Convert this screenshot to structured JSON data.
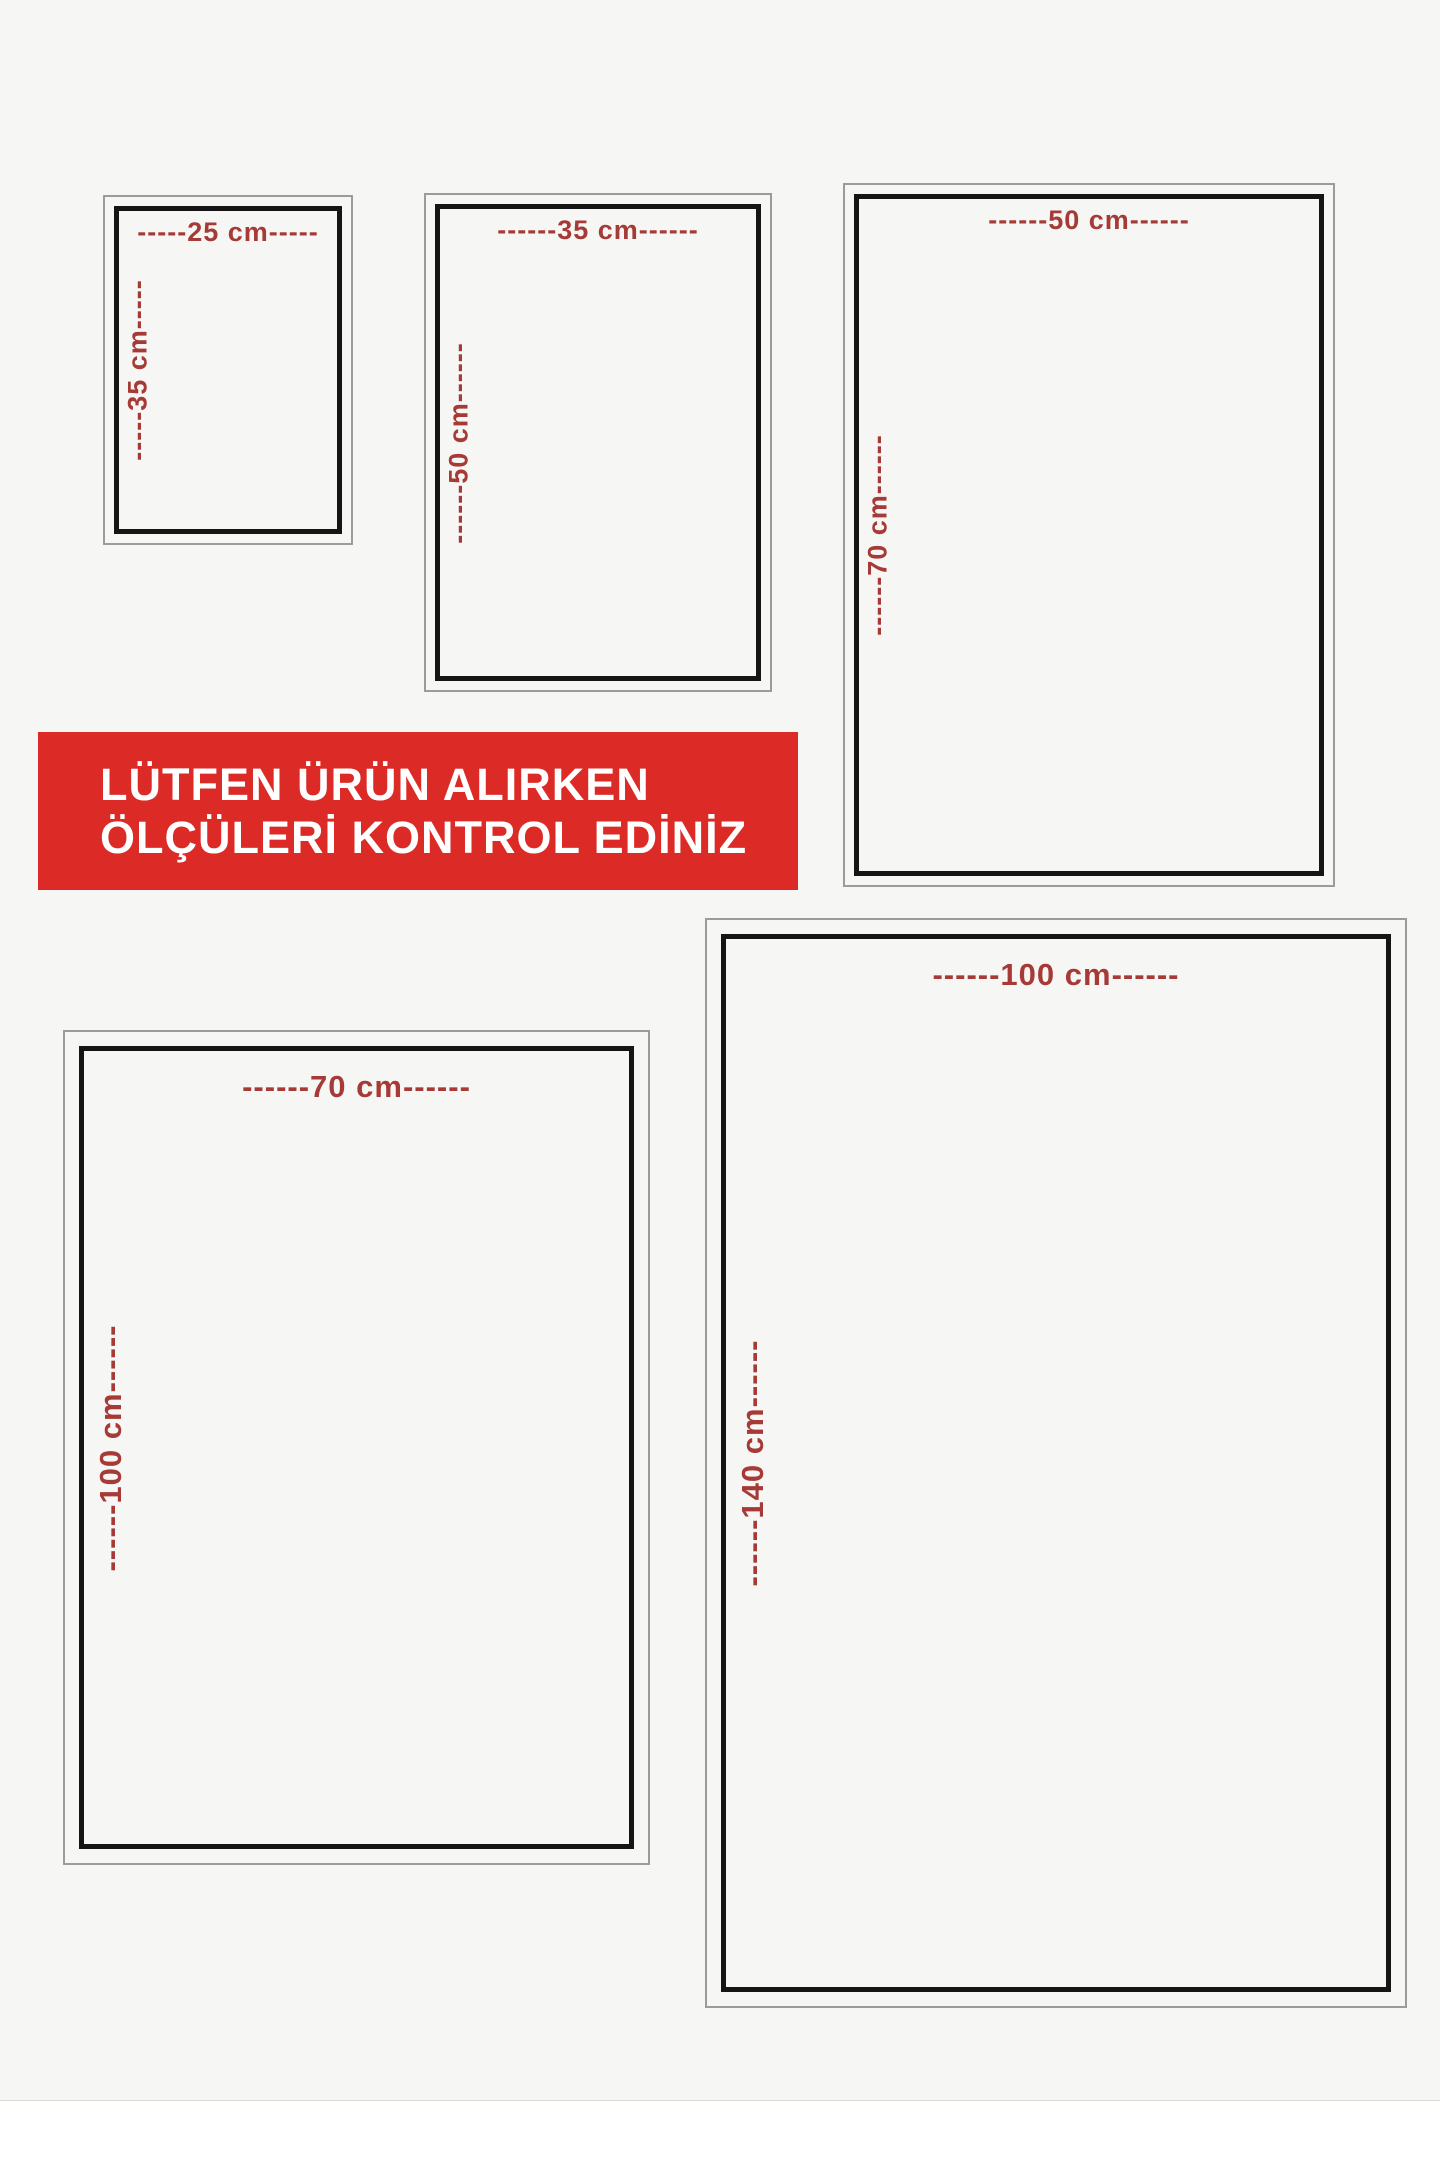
{
  "banner": {
    "line1": "LÜTFEN ÜRÜN ALIRKEN",
    "line2": "ÖLÇÜLERİ KONTROL EDİNİZ"
  },
  "boxes": [
    {
      "size_name": "25x35 cm",
      "width_cm": 25,
      "height_cm": 35,
      "width_label": "-----25 cm-----",
      "height_label": "-----35 cm-----"
    },
    {
      "size_name": "35x50 cm",
      "width_cm": 35,
      "height_cm": 50,
      "width_label": "------35 cm------",
      "height_label": "------50 cm------"
    },
    {
      "size_name": "50x70 cm",
      "width_cm": 50,
      "height_cm": 70,
      "width_label": "------50 cm------",
      "height_label": "------70 cm------"
    },
    {
      "size_name": "70x100 cm",
      "width_cm": 70,
      "height_cm": 100,
      "width_label": "------70 cm------",
      "height_label": "------100 cm------"
    },
    {
      "size_name": "100x140 cm",
      "width_cm": 100,
      "height_cm": 140,
      "width_label": "------100 cm------",
      "height_label": "------140 cm------"
    }
  ],
  "colors": {
    "banner-bg": "#dc2b26",
    "banner-text": "#ffffff",
    "label": "#a63a36",
    "border-black": "#151515",
    "border-gray": "#9b9b9b",
    "bg": "#f6f6f4",
    "page-white": "#ffffff"
  }
}
